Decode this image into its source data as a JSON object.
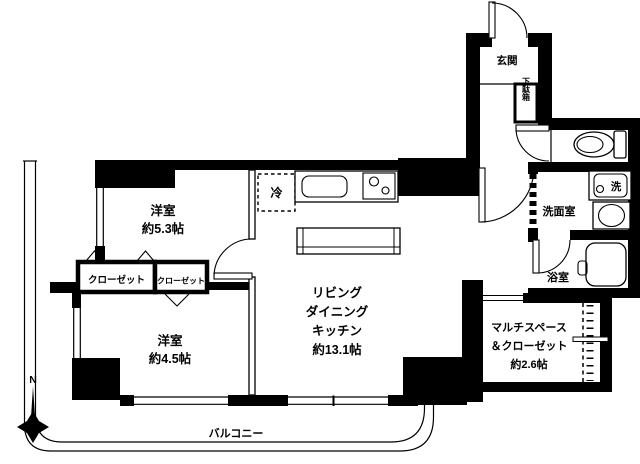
{
  "plan": {
    "compass_label": "N",
    "balcony_label": "バルコニー",
    "rooms": {
      "entrance": {
        "label": "玄関"
      },
      "shoe_cabinet": {
        "label": "下駄箱"
      },
      "bedroom1": {
        "label": "洋室",
        "size": "約5.3帖"
      },
      "bedroom2": {
        "label": "洋室",
        "size": "約4.5帖"
      },
      "closet_large": {
        "label": "クローゼット"
      },
      "closet_small": {
        "label": "クローゼット"
      },
      "ldk": {
        "line1": "リビング",
        "line2": "ダイニング",
        "line3": "キッチン",
        "size": "約13.1帖"
      },
      "washroom": {
        "label": "洗面室"
      },
      "bathroom": {
        "label": "浴室"
      },
      "multi_space": {
        "line1": "マルチスペース",
        "line2": "＆クローゼット",
        "size": "約2.6帖"
      }
    },
    "fixtures": {
      "refrigerator_label": "冷",
      "washer_label": "洗"
    },
    "colors": {
      "wall": "#000000",
      "line": "#1a1a1a",
      "background": "#ffffff"
    }
  }
}
